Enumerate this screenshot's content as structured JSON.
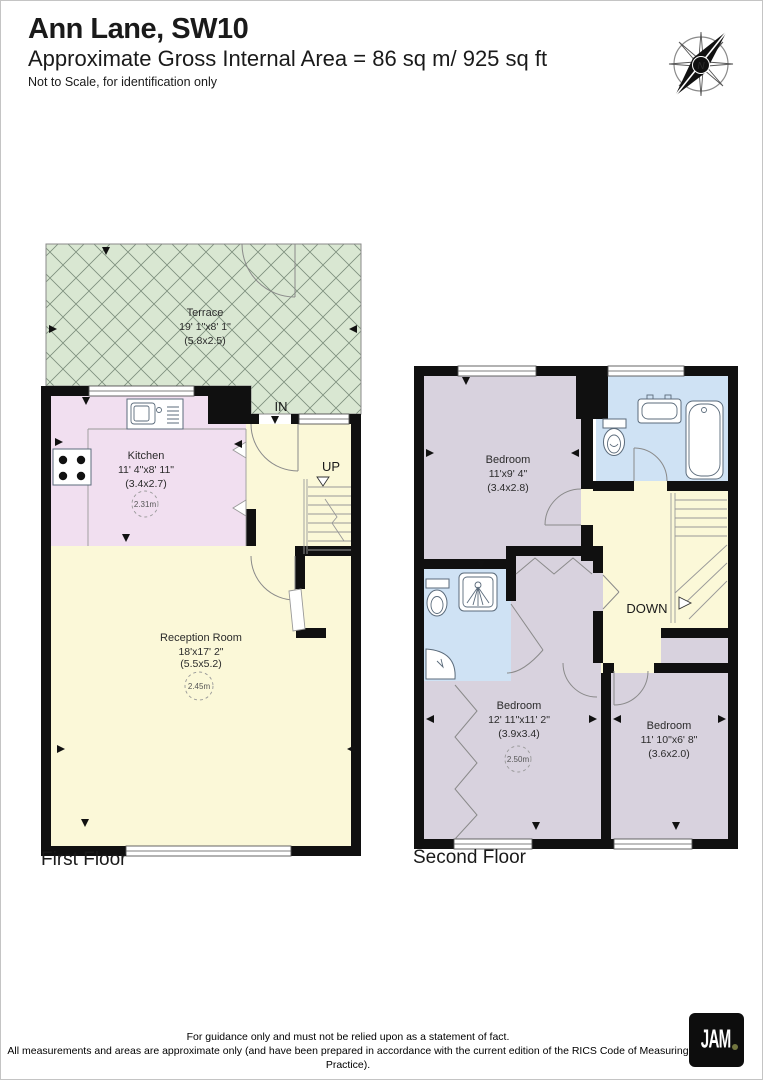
{
  "header": {
    "title": "Ann Lane, SW10",
    "subtitle": "Approximate Gross Internal Area = 86 sq m/ 925 sq ft",
    "note": "Not to Scale, for identification only"
  },
  "compass": {
    "north_label": "N"
  },
  "first_floor": {
    "label": "First Floor",
    "entry_label": "IN",
    "stairs_label": "UP",
    "rooms": {
      "terrace": {
        "name": "Terrace",
        "dims_ft": "19' 1\"x8' 1\"",
        "dims_m": "(5.8x2.5)"
      },
      "kitchen": {
        "name": "Kitchen",
        "dims_ft": "11' 4\"x8' 11\"",
        "dims_m": "(3.4x2.7)",
        "ceiling_height": "2.31m"
      },
      "reception": {
        "name": "Reception Room",
        "dims_ft": "18'x17' 2\"",
        "dims_m": "(5.5x5.2)",
        "ceiling_height": "2.45m"
      }
    }
  },
  "second_floor": {
    "label": "Second Floor",
    "stairs_label": "DOWN",
    "rooms": {
      "bedroom1": {
        "name": "Bedroom",
        "dims_ft": "11'x9' 4\"",
        "dims_m": "(3.4x2.8)"
      },
      "bedroom2": {
        "name": "Bedroom",
        "dims_ft": "12' 11\"x11' 2\"",
        "dims_m": "(3.9x3.4)",
        "ceiling_height": "2.50m"
      },
      "bedroom3": {
        "name": "Bedroom",
        "dims_ft": "11' 10\"x6' 8\"",
        "dims_m": "(3.6x2.0)"
      }
    }
  },
  "footer": {
    "line1": "For guidance only and must not be relied upon as a statement of fact.",
    "line2": "All measurements and areas are approximate only (and have been prepared in accordance with the current edition of the RICS Code of Measuring Practice).",
    "logo_text": "JAM"
  },
  "colors": {
    "terrace": "#d9e7d2",
    "kitchen": "#f1dff0",
    "living": "#fbf8d8",
    "bedroom": "#d8d2de",
    "bathroom": "#cfe2f4",
    "wall": "#101010",
    "logo_dot": "#72753f"
  }
}
